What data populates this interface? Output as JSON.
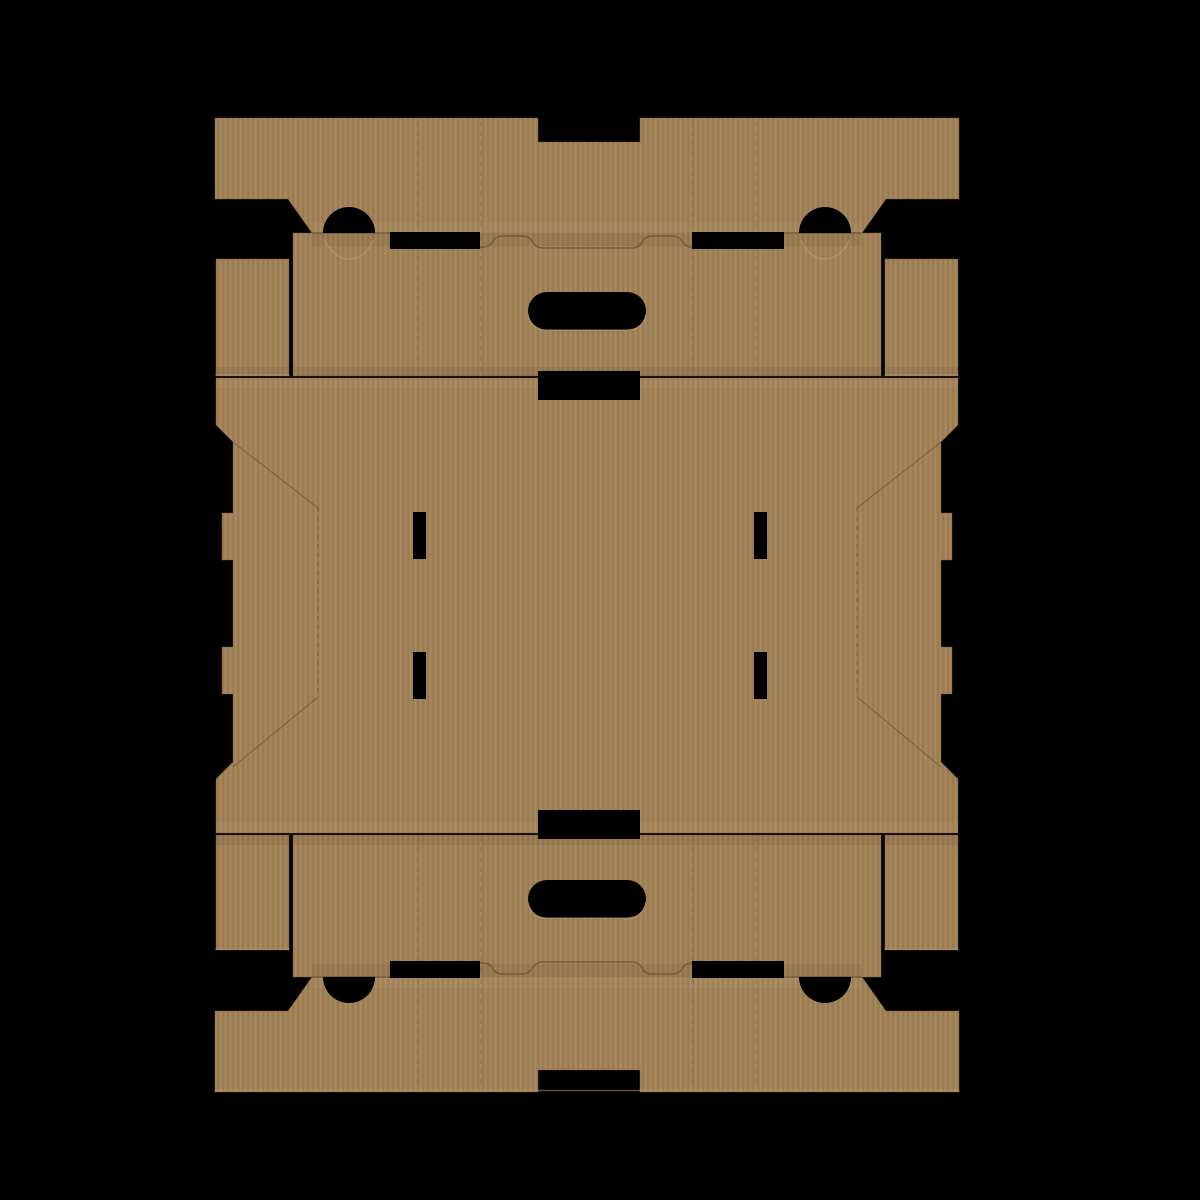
{
  "scene": {
    "label": "Flat corrugated cardboard box dieline blank on black background",
    "colors": {
      "background": "#000000",
      "card_base": "#a18157",
      "card_light": "#a9895f",
      "card_dark": "#97784e",
      "card_edge": "#7d6340",
      "crease": "#6b5434",
      "seam": "#1a120a",
      "hole": "#000000",
      "rim": "#c0a074",
      "shade_dark": "#000000",
      "shade_light": "#ffffff"
    },
    "paths": {
      "top_sheet": "M215,118 H538 V142 H640 V118 H959 V199 H886 L862,233 H881 V376 H293 V233 H312 L288,199 H215 Z",
      "bottom_sheet": "M215,1092 H538 V1070 H640 V1092 H959 V1011 H886 L862,977 H881 V835 H293 V977 H312 L288,1011 H215 Z",
      "end_flaps": "M216,259 H289 V376 H216 Z M885,259 H958 V376 H885 Z M216,835 H289 V950 H216 Z M885,835 H958 V950 H885 Z",
      "panel": "M216,378 H958 V425 L941,442 V513 H952 V560 H941 V647 H952 V694 H941 V762 L958,779 V833 H216 V779 L233,762 V694 H222 V647 H233 V560 H222 V513 H233 V442 L216,425 Z",
      "shade_dark": "M312,233 H862 V246 H312 Z M216,367 H958 V377 H216 Z M216,835 H958 V845 H216 Z M312,964 H862 V977 H312 Z",
      "shade_light": "M312,223 H862 V232 H312 Z M216,378 H958 V388 H216 Z M216,823 H958 V833 H216 Z M312,978 H862 V988 H312 Z",
      "seam_lines": "M216,377 H958 M216,834 H958",
      "fold_creases": "M312,233 H390 M480,247 Q490,248 493,241 Q496,236 502,236 H522 Q529,236 532,241 Q536,248 543,248 H632 Q639,248 642,242 Q645,236 652,236 H672 Q679,236 682,241 Q685,247 692,247 M784,233 H862 M312,977 H390 M480,963 Q490,962 493,969 Q496,974 502,974 H522 Q529,974 532,969 Q536,962 543,962 H632 Q639,962 642,968 Q645,974 652,974 H672 Q679,974 682,969 Q685,963 692,963 M784,977 H862",
      "panel_diagonals": "M233,442 L318,508 M318,697 L233,767 M941,442 L857,508 M857,697 L941,767",
      "panel_dashed": "M318,508 V697 M857,508 V697",
      "sheet_dashed": "M418,121 V231 M481,121 V231 M693,121 V231 M756,121 V231 M418,236 V374 M481,236 V374 M693,236 V374 M756,236 V374 M418,837 V975 M481,837 V975 M693,837 V975 M756,837 V975 M418,979 V1089 M481,979 V1089 M693,979 V1089 M756,979 V1089",
      "cutouts": "M323,233 A26,26 0 0 1 375,233 Z M799,233 A26,26 0 0 1 851,233 Z M390,232 H480 V249 H390 Z M692,232 H784 V249 H692 Z M547,292 H627 A19,19 0 0 1 627,330 H547 A19,19 0 0 1 547,292 Z M538,371 H640 V400 H538 Z M413,512 H426 V559 H413 Z M754,512 H767 V559 H754 Z M413,652 H426 V699 H413 Z M754,652 H767 V699 H754 Z M538,810 H640 V839 H538 Z M547,880 H627 A19,19 0 0 1 627,918 H547 A19,19 0 0 1 547,880 Z M390,961 H480 V978 H390 Z M692,961 H784 V978 H692 Z M323,977 A26,26 0 0 0 375,977 Z M799,977 A26,26 0 0 0 851,977 Z",
      "rim_highlights": "M216,375 H289 M885,375 H958 M216,949 H289 M885,949 H958 M215,1090.5 H959 M528,315 Q531,330 547,330 H627 Q643,330 646,315 M528,903 Q531,918 547,918 H627 Q643,918 646,903 M325,241 Q334,259 349,259 Q364,259 373,241 M801,241 Q810,259 825,259 Q840,259 849,241"
    }
  }
}
